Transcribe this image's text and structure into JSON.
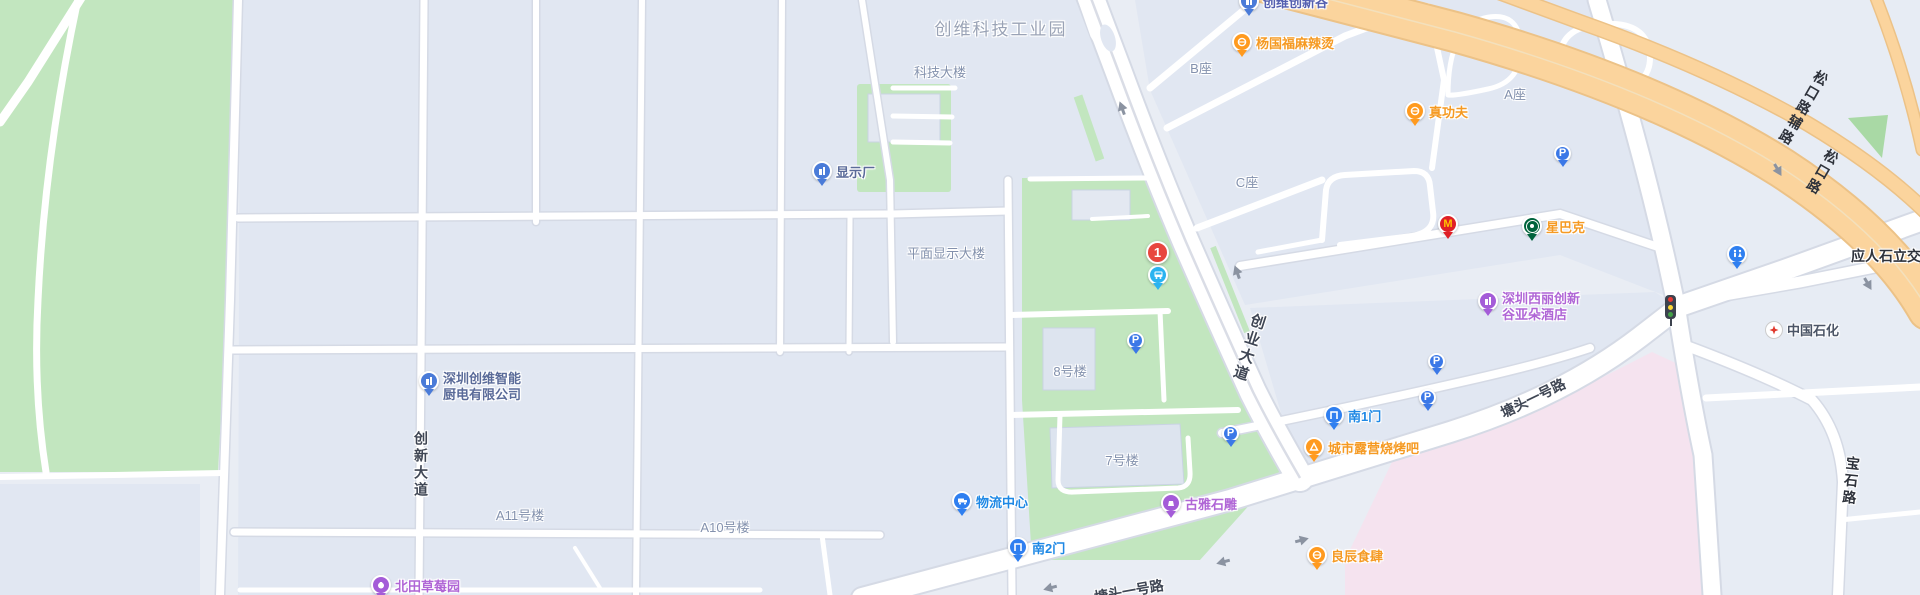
{
  "area_labels": {
    "industrial_park": "创维科技工业园",
    "tech_building": "科技大楼",
    "block_b": "B座",
    "block_c": "C座",
    "block_a": "A座",
    "flat_display_building": "平面显示大楼",
    "building_8": "8号楼",
    "building_7": "7号楼",
    "building_a11": "A11号楼",
    "building_a10": "A10号楼"
  },
  "pois": {
    "innovation_valley": {
      "label": "创维创新谷"
    },
    "yangguofu_malatang": {
      "label": "杨国福麻辣烫"
    },
    "zhen_gongfu": {
      "label": "真功夫"
    },
    "starbucks": {
      "label": "星巴克"
    },
    "display_factory": {
      "label": "显示厂"
    },
    "skyworth_kitchen": {
      "line1": "深圳创维智能",
      "line2": "厨电有限公司"
    },
    "atour_hotel": {
      "line1": "深圳西丽创新",
      "line2": "谷亚朵酒店"
    },
    "logistics_center": {
      "label": "物流中心"
    },
    "south_gate_2": {
      "label": "南2门"
    },
    "south_gate_1": {
      "label": "南1门"
    },
    "beitian_strawberry": {
      "label": "北田草莓园"
    },
    "liangchen_restaurant": {
      "label": "良辰食肆"
    },
    "city_camping_bbq": {
      "label": "城市露营烧烤吧"
    },
    "guya_stone_carving": {
      "label": "古雅石雕"
    },
    "sinopec": {
      "label": "中国石化"
    }
  },
  "road_labels": {
    "chuangye_avenue": "创业大道",
    "chuangxin_avenue": "创新大道",
    "tangtou_no1_road_upper": "塘头一号路",
    "tangtou_no1_road_lower": "塘头一号路",
    "songkou_road_auxiliary": "松口路辅路",
    "songkou_road": "松口路",
    "yingrenshi_interchange": "应人石立交",
    "baoshi_road": "宝石路"
  },
  "markers": {
    "route_stop_number": "1",
    "mcdonalds_initial": "M",
    "parking_letter": "P"
  },
  "colors": {
    "poi_orange": "#f59a23",
    "poi_purple": "#b066d6",
    "poi_blue_gray": "#5a6b99",
    "gate_blue": "#1e88e5",
    "marker_red": "#e8463f",
    "bus_pin_blue": "#2bb3f0",
    "parking_blue": "#3b78e7",
    "mcdonalds_red": "#df1f26",
    "starbucks_green": "#00643c",
    "road_yellow": "#fbd49d",
    "park_green": "#c2e6bf",
    "building_pink": "#f5e3ef"
  }
}
